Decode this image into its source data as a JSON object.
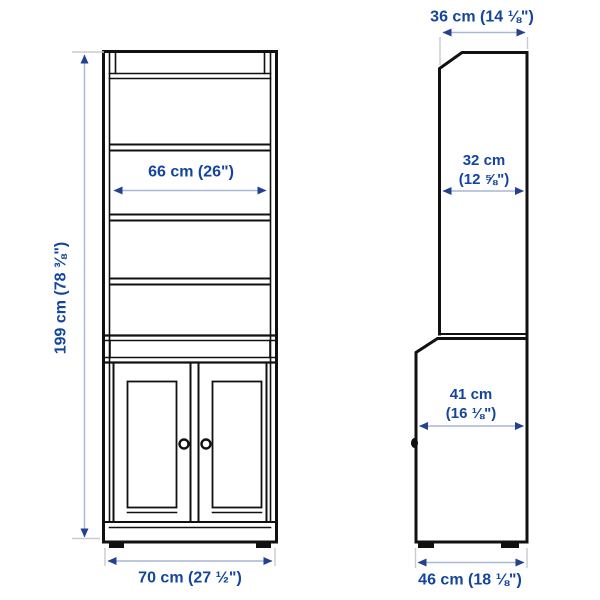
{
  "colors": {
    "bg": "#ffffff",
    "furniture_line": "#111111",
    "dim_text": "#14459e",
    "dim_line": "#a9b7d6",
    "dim_arrow": "#23418f",
    "ext_line": "#c7cbd2"
  },
  "front_view": {
    "height": {
      "label": "199 cm (78 ⅜\")"
    },
    "width": {
      "label": "70 cm (27 ½\")"
    },
    "shelf_width": {
      "label": "66 cm (26\")"
    }
  },
  "side_view": {
    "top_depth": {
      "label": "36 cm (14 ⅛\")"
    },
    "upper_depth": {
      "line1": "32 cm",
      "line2": "(12 ⅝\")"
    },
    "lower_depth": {
      "line1": "41 cm",
      "line2": "(16 ⅛\")"
    },
    "base_depth": {
      "label": "46 cm (18 ⅛\")"
    }
  }
}
